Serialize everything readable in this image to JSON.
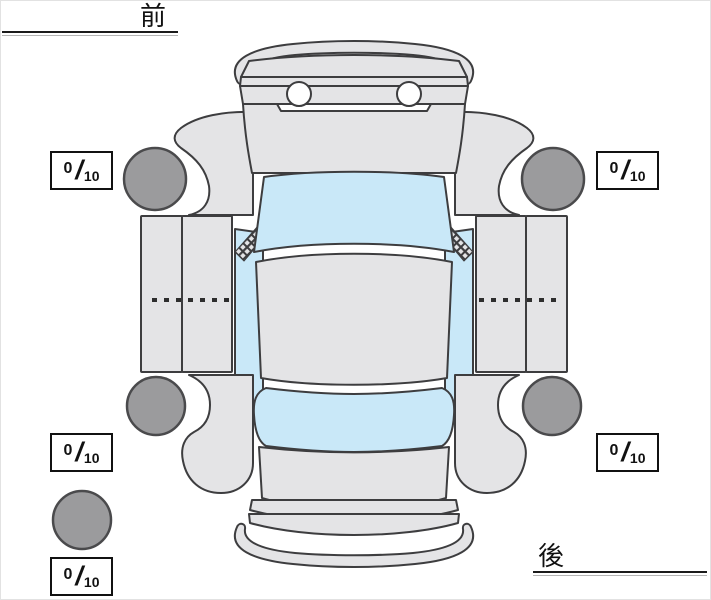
{
  "labels": {
    "front": "前",
    "rear": "後"
  },
  "separator": "/",
  "ratings": {
    "front_left": {
      "value": "0",
      "max": "10"
    },
    "front_right": {
      "value": "0",
      "max": "10"
    },
    "rear_left": {
      "value": "0",
      "max": "10"
    },
    "rear_right": {
      "value": "0",
      "max": "10"
    },
    "spare": {
      "value": "0",
      "max": "10"
    }
  },
  "colors": {
    "body": "#e4e4e6",
    "glass": "#c9e8f8",
    "tire": "#9b9b9d",
    "highlight": "#ffffff"
  }
}
